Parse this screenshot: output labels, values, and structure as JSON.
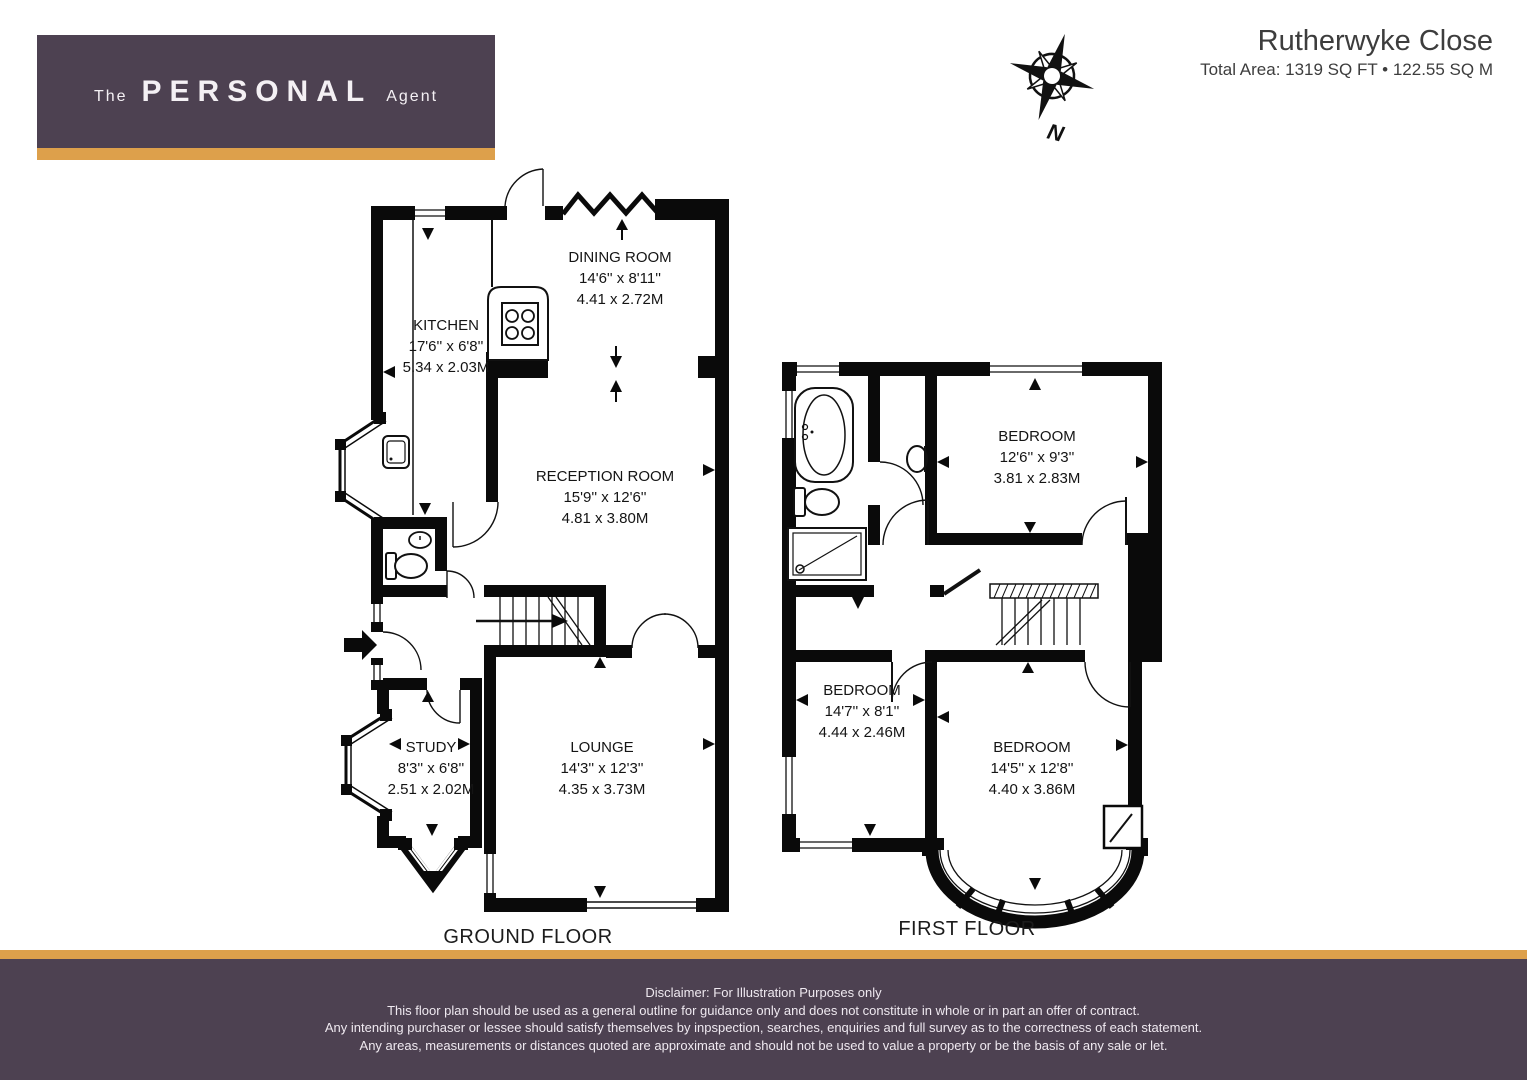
{
  "brand": {
    "the": "The",
    "name": "PERSONAL",
    "agent": "Agent"
  },
  "header": {
    "title": "Rutherwyke Close",
    "subtitle": "Total Area: 1319 SQ FT • 122.55 SQ M"
  },
  "compass": {
    "label": "N"
  },
  "colors": {
    "brand_purple": "#4d4151",
    "brand_gold": "#DDA04B",
    "wall_black": "#0a0a0a"
  },
  "floors": [
    {
      "label": "GROUND FLOOR",
      "rooms": [
        {
          "name": "DINING ROOM",
          "imperial": "14'6'' x 8'11''",
          "metric": "4.41 x 2.72M"
        },
        {
          "name": "KITCHEN",
          "imperial": "17'6'' x 6'8''",
          "metric": "5.34 x 2.03M"
        },
        {
          "name": "RECEPTION ROOM",
          "imperial": "15'9'' x 12'6''",
          "metric": "4.81 x 3.80M"
        },
        {
          "name": "STUDY",
          "imperial": "8'3'' x 6'8''",
          "metric": "2.51 x 2.02M"
        },
        {
          "name": "LOUNGE",
          "imperial": "14'3'' x 12'3''",
          "metric": "4.35 x 3.73M"
        }
      ]
    },
    {
      "label": "FIRST FLOOR",
      "rooms": [
        {
          "name": "BEDROOM",
          "imperial": "12'6'' x 9'3''",
          "metric": "3.81 x 2.83M"
        },
        {
          "name": "BEDROOM",
          "imperial": "14'7'' x 8'1''",
          "metric": "4.44 x 2.46M"
        },
        {
          "name": "BEDROOM",
          "imperial": "14'5'' x 12'8''",
          "metric": "4.40 x 3.86M"
        }
      ]
    }
  ],
  "footer": {
    "lines": [
      "Disclaimer: For Illustration Purposes only",
      "This floor plan should be used as a general outline for guidance only and does not constitute in whole or in part an offer of contract.",
      "Any intending purchaser or lessee should satisfy themselves by inpspection, searches, enquiries and full survey as to the correctness of each statement.",
      "Any areas, measurements or distances quoted are approximate and should not be used to value a property or be the basis of any sale or let."
    ]
  }
}
